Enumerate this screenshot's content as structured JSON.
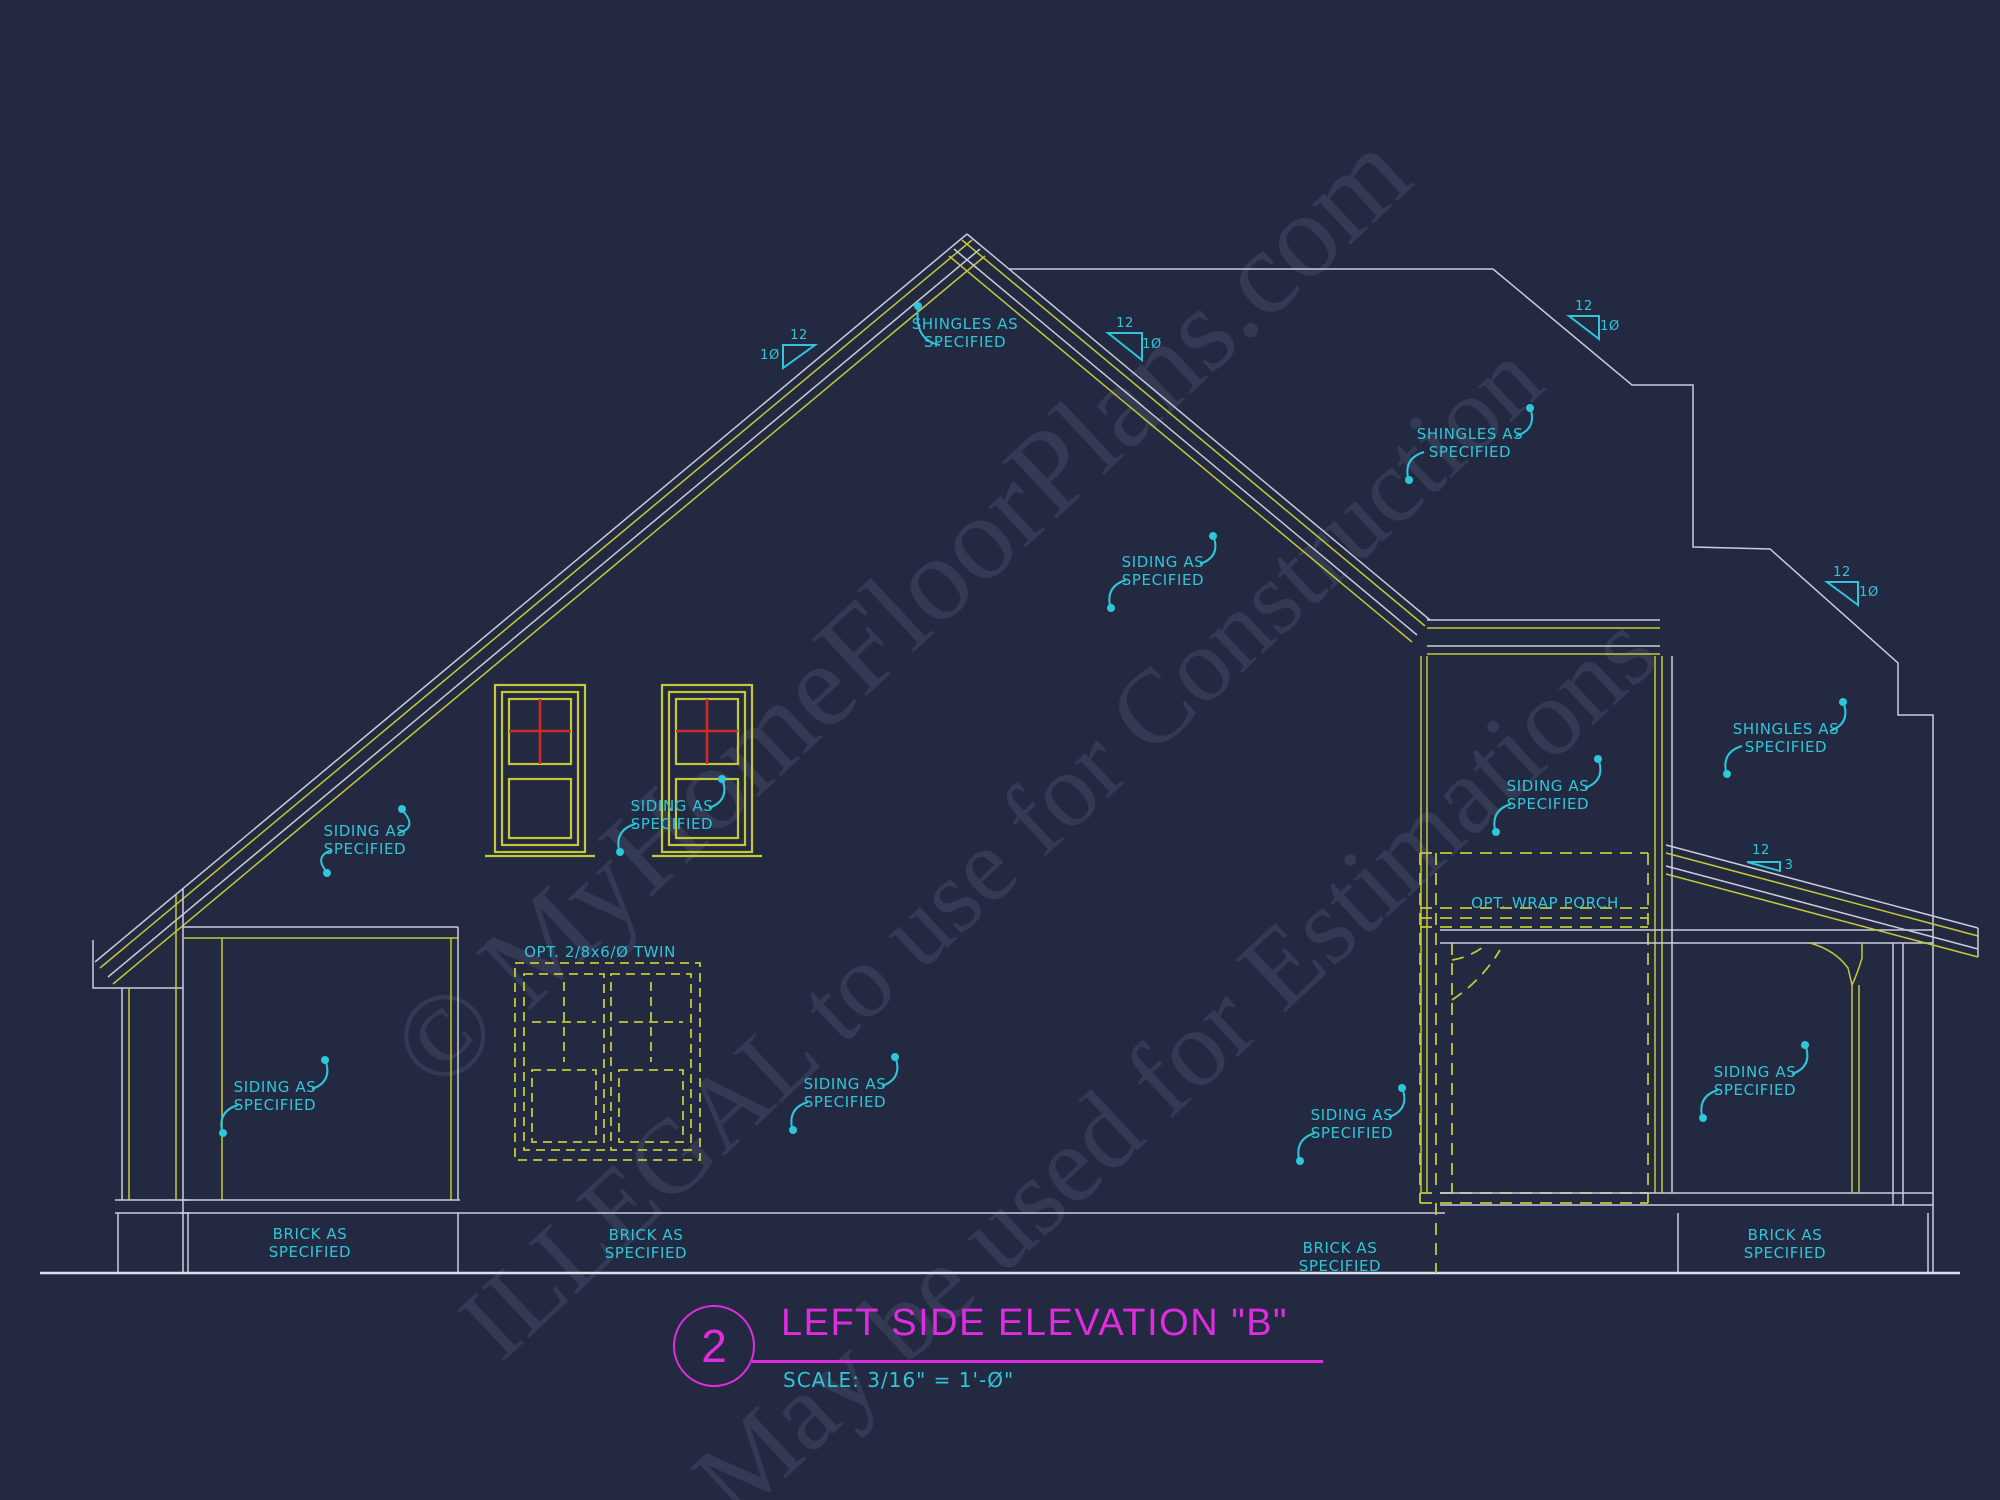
{
  "title_block": {
    "sheet_number": "2",
    "title": "LEFT SIDE ELEVATION \"B\"",
    "scale": "SCALE: 3/16\" = 1'-Ø\""
  },
  "watermark": {
    "line1": "© MyHomeFloorPlans.com",
    "line2": "ILLEGAL to use for Construction",
    "line3": "May be used for Estimations"
  },
  "colors": {
    "background": "#242942",
    "line_white": "#c9cdd9",
    "line_yellow": "#c3c937",
    "annotation_cyan": "#2ec6d8",
    "title_magenta": "#df2ce0",
    "window_red": "#ce2b28",
    "ground_line": "#dfe2ec"
  },
  "annotations": [
    {
      "id": "shingles-1",
      "x": 965,
      "y": 333,
      "fs": 15,
      "lines": [
        "SHINGLES AS",
        "SPECIFIED"
      ]
    },
    {
      "id": "shingles-2",
      "x": 1470,
      "y": 443,
      "fs": 15,
      "lines": [
        "SHINGLES AS",
        "SPECIFIED"
      ]
    },
    {
      "id": "shingles-3",
      "x": 1786,
      "y": 738,
      "fs": 15,
      "lines": [
        "SHINGLES AS",
        "SPECIFIED"
      ]
    },
    {
      "id": "siding-1",
      "x": 365,
      "y": 840,
      "fs": 15,
      "lines": [
        "SIDING AS",
        "SPECIFIED"
      ]
    },
    {
      "id": "siding-2",
      "x": 672,
      "y": 815,
      "fs": 15,
      "lines": [
        "SIDING AS",
        "SPECIFIED"
      ]
    },
    {
      "id": "siding-3",
      "x": 1163,
      "y": 571,
      "fs": 15,
      "lines": [
        "SIDING AS",
        "SPECIFIED"
      ]
    },
    {
      "id": "siding-4",
      "x": 1548,
      "y": 795,
      "fs": 15,
      "lines": [
        "SIDING AS",
        "SPECIFIED"
      ]
    },
    {
      "id": "siding-5",
      "x": 275,
      "y": 1096,
      "fs": 15,
      "lines": [
        "SIDING AS",
        "SPECIFIED"
      ]
    },
    {
      "id": "siding-6",
      "x": 845,
      "y": 1093,
      "fs": 15,
      "lines": [
        "SIDING AS",
        "SPECIFIED"
      ]
    },
    {
      "id": "siding-7",
      "x": 1352,
      "y": 1124,
      "fs": 15,
      "lines": [
        "SIDING AS",
        "SPECIFIED"
      ]
    },
    {
      "id": "siding-8",
      "x": 1755,
      "y": 1081,
      "fs": 15,
      "lines": [
        "SIDING AS",
        "SPECIFIED"
      ]
    },
    {
      "id": "brick-1",
      "x": 310,
      "y": 1243,
      "fs": 15,
      "lines": [
        "BRICK AS",
        "SPECIFIED"
      ]
    },
    {
      "id": "brick-2",
      "x": 646,
      "y": 1244,
      "fs": 15,
      "lines": [
        "BRICK AS",
        "SPECIFIED"
      ]
    },
    {
      "id": "brick-3",
      "x": 1340,
      "y": 1257,
      "fs": 15,
      "lines": [
        "BRICK AS",
        "SPECIFIED"
      ]
    },
    {
      "id": "brick-4",
      "x": 1785,
      "y": 1244,
      "fs": 15,
      "lines": [
        "BRICK AS",
        "SPECIFIED"
      ]
    },
    {
      "id": "opt-wrap-porch",
      "x": 1545,
      "y": 903,
      "fs": 15,
      "lines": [
        "OPT. WRAP PORCH"
      ]
    },
    {
      "id": "opt-twin-door",
      "x": 600,
      "y": 952,
      "fs": 15,
      "lines": [
        "OPT. 2/8x6/Ø TWIN"
      ]
    },
    {
      "id": "pitch-1-run",
      "x": 799,
      "y": 336,
      "fs": 13,
      "lines": [
        "12"
      ]
    },
    {
      "id": "pitch-1-rise",
      "x": 770,
      "y": 356,
      "fs": 13,
      "lines": [
        "1Ø"
      ]
    },
    {
      "id": "pitch-2-run",
      "x": 1125,
      "y": 324,
      "fs": 13,
      "lines": [
        "12"
      ]
    },
    {
      "id": "pitch-2-rise",
      "x": 1152,
      "y": 345,
      "fs": 13,
      "lines": [
        "1Ø"
      ]
    },
    {
      "id": "pitch-3-run",
      "x": 1584,
      "y": 307,
      "fs": 13,
      "lines": [
        "12"
      ]
    },
    {
      "id": "pitch-3-rise",
      "x": 1610,
      "y": 327,
      "fs": 13,
      "lines": [
        "1Ø"
      ]
    },
    {
      "id": "pitch-4-run",
      "x": 1842,
      "y": 573,
      "fs": 13,
      "lines": [
        "12"
      ]
    },
    {
      "id": "pitch-4-rise",
      "x": 1869,
      "y": 593,
      "fs": 13,
      "lines": [
        "1Ø"
      ]
    },
    {
      "id": "pitch-5-run",
      "x": 1761,
      "y": 851,
      "fs": 13,
      "lines": [
        "12"
      ]
    },
    {
      "id": "pitch-5-rise",
      "x": 1789,
      "y": 866,
      "fs": 13,
      "lines": [
        "3"
      ]
    }
  ]
}
